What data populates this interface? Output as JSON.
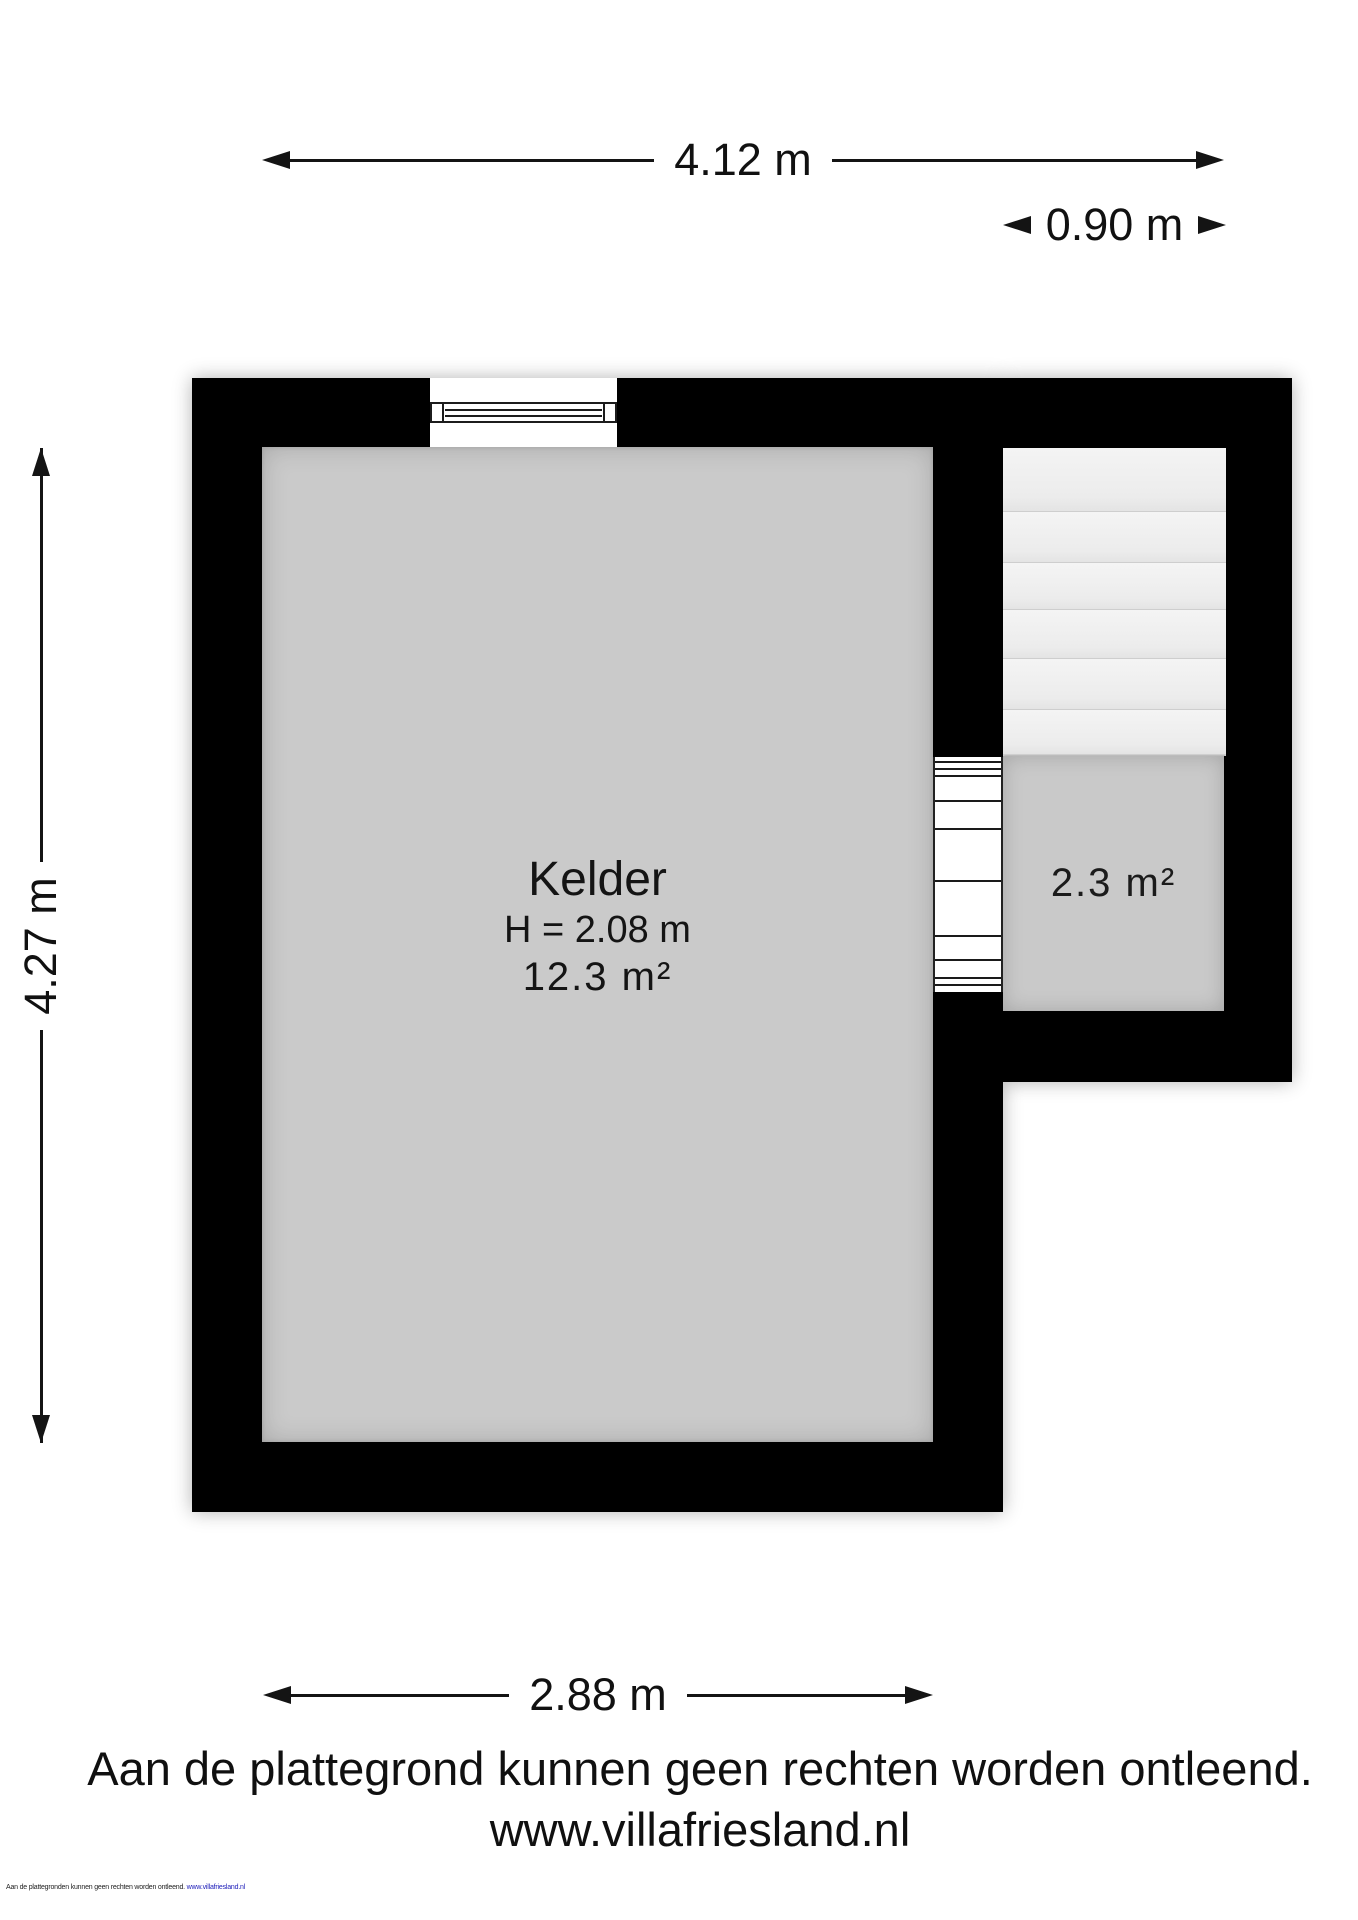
{
  "dimensions": {
    "top": "4.12 m",
    "stair": "0.90 m",
    "left": "4.27 m",
    "bottom": "2.88 m"
  },
  "rooms": {
    "kelder": {
      "name": "Kelder",
      "ceiling_height": "H = 2.08 m",
      "area": "12.3 m²"
    },
    "stair_room": {
      "area": "2.3 m²"
    }
  },
  "staircase": {
    "steps": 6
  },
  "footer": {
    "disclaimer": "Aan de plattegrond kunnen geen rechten worden ontleend.",
    "website": "www.villafriesland.nl"
  },
  "fine_print": {
    "text": "Aan de plattegronden kunnen geen rechten worden ontleend.",
    "website": "www.villafriesland.nl"
  },
  "colors": {
    "wall": "#000000",
    "kelder_floor": "#cacaca",
    "stair_floor": "#c9c9c9",
    "stair_tread": "#efefef",
    "dimension_line": "#141414",
    "fine_print_url": "#2222bb"
  }
}
